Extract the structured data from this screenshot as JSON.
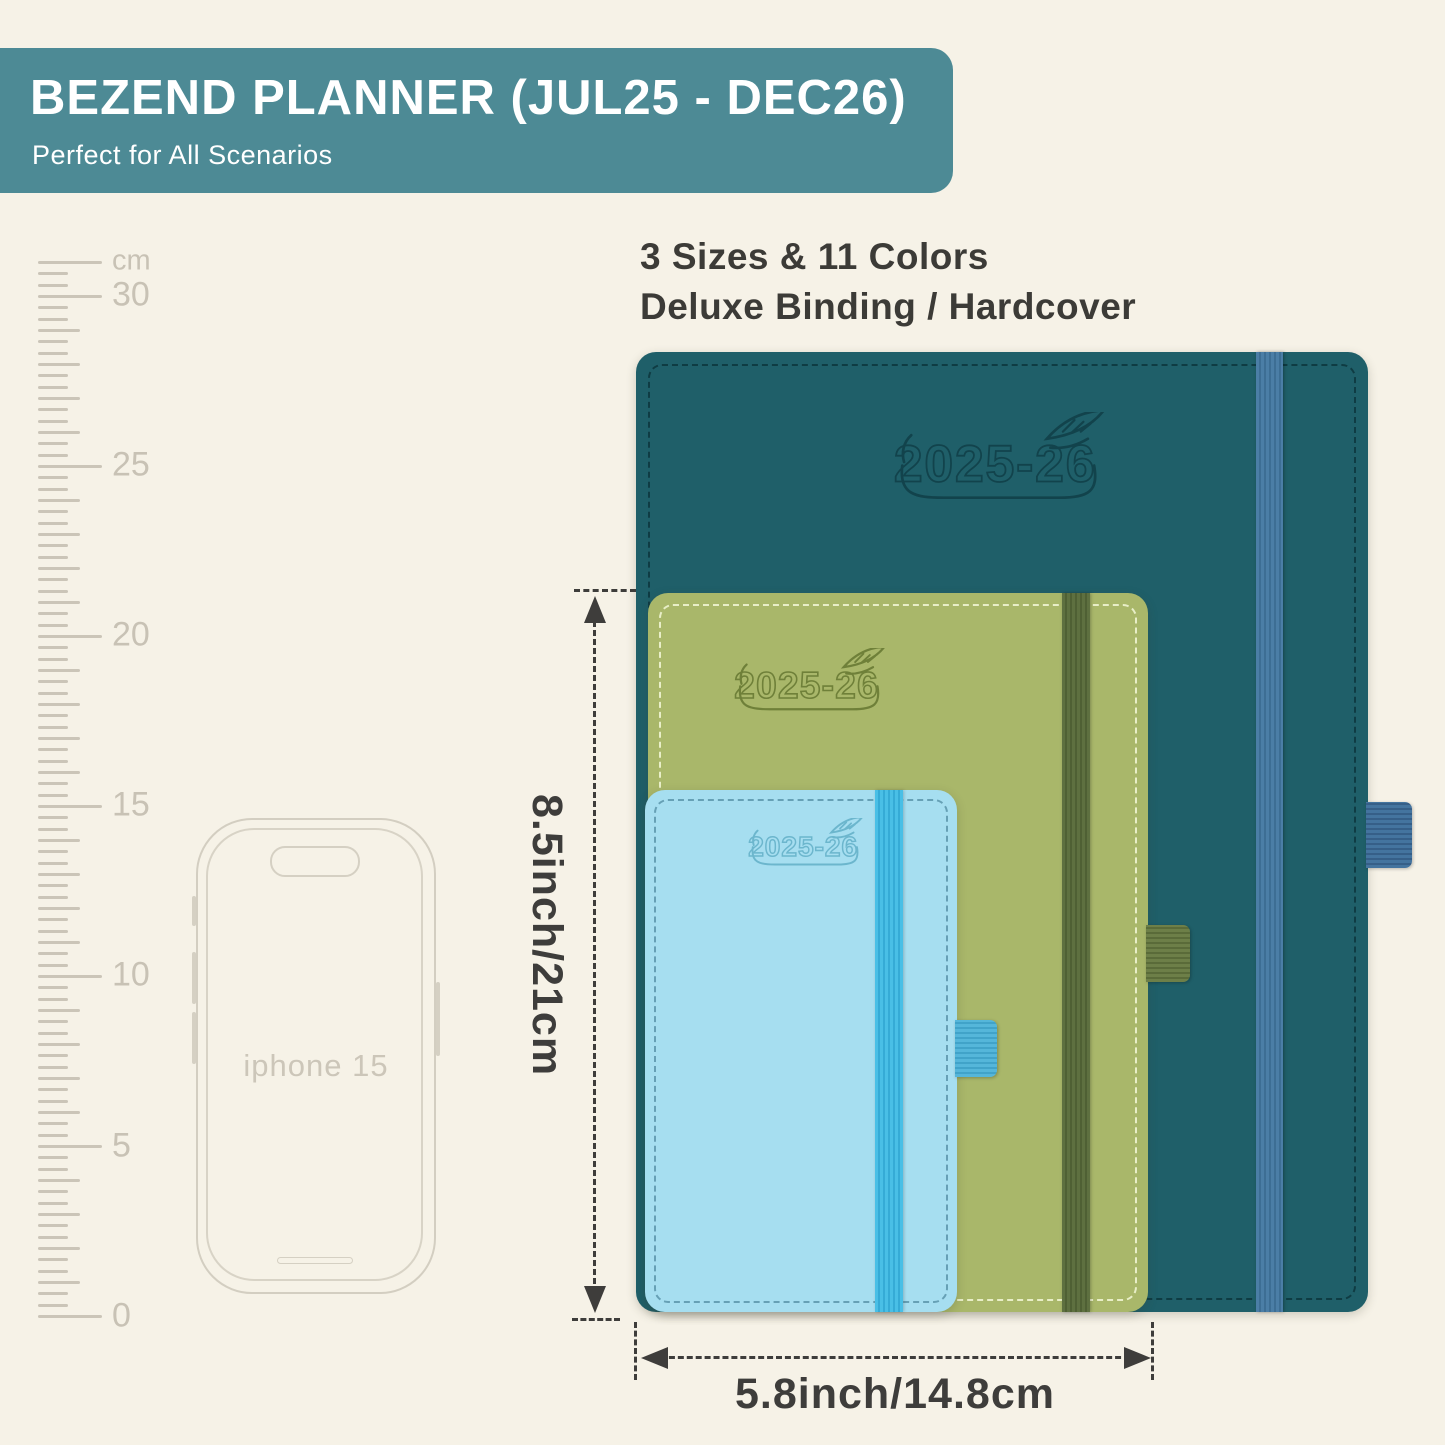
{
  "banner": {
    "title": "BEZEND PLANNER (JUL25 - DEC26)",
    "subtitle": "Perfect for All Scenarios",
    "bg_color": "#4d8a95",
    "text_color": "#ffffff"
  },
  "headline": {
    "line1": "3 Sizes & 11 Colors",
    "line2": "Deluxe Binding / Hardcover"
  },
  "ruler": {
    "labels": [
      {
        "text": "cm",
        "y": 261
      },
      {
        "text": "30",
        "y": 295
      },
      {
        "text": "25",
        "y": 465
      },
      {
        "text": "20",
        "y": 635
      },
      {
        "text": "15",
        "y": 805
      },
      {
        "text": "10",
        "y": 975
      },
      {
        "text": "5",
        "y": 1146
      },
      {
        "text": "0",
        "y": 1316
      }
    ],
    "tick_color": "#cbc5b8",
    "label_color": "#c8c2b5"
  },
  "phone": {
    "label": "iphone 15",
    "outline_color": "#d3cec1"
  },
  "planners": [
    {
      "name": "large-planner",
      "logo_year": "2025-26",
      "cover_color": "#1f5f69",
      "elastic_color": "#4b7ea6",
      "pen_loop_color": "#44749f",
      "logo_color": "#12434c"
    },
    {
      "name": "medium-planner",
      "logo_year": "2025-26",
      "cover_color": "#a9b76a",
      "elastic_color": "#5e7040",
      "pen_loop_color": "#6d7f48",
      "logo_color": "#6f8039"
    },
    {
      "name": "small-planner",
      "logo_year": "2025-26",
      "cover_color": "#a6def0",
      "elastic_color": "#49bfe6",
      "pen_loop_color": "#55b6da",
      "logo_color": "#6cb6cd"
    }
  ],
  "dimensions": {
    "height_label": "8.5inch/21cm",
    "width_label": "5.8inch/14.8cm",
    "line_color": "#3e3d3b"
  },
  "background_color": "#f6f2e7"
}
